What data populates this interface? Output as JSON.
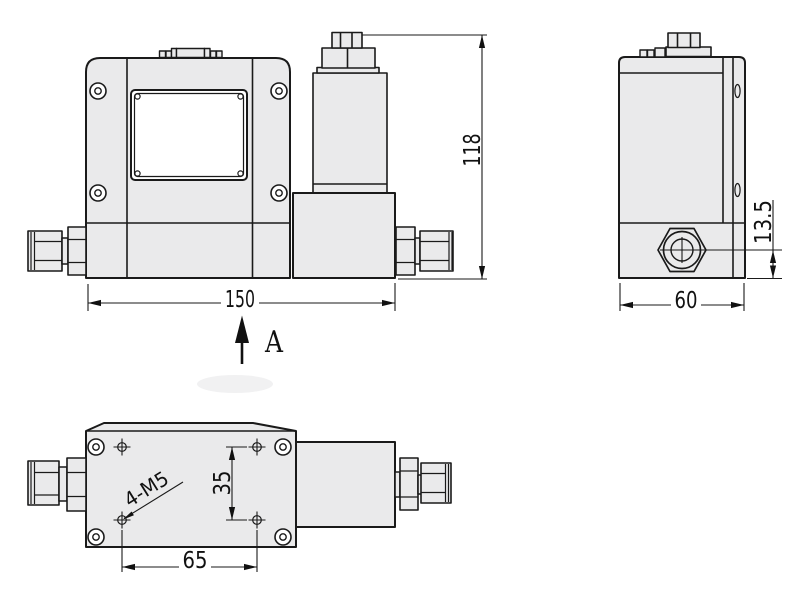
{
  "drawing": {
    "type": "engineering-dimension-drawing",
    "device": "flow-controller-outline",
    "dimensions": {
      "overall_width": "150",
      "overall_height": "118",
      "body_depth": "60",
      "outlet_center_height": "13.5",
      "mount_hole_pitch_vertical": "35",
      "mount_hole_pitch_horizontal": "65",
      "mount_hole_thread": "4-M5"
    },
    "view_label": "A",
    "colors": {
      "background": "#ffffff",
      "body_fill": "#eaeaeb",
      "line_color": "#1a1a1a",
      "dim_color": "#111111"
    }
  }
}
